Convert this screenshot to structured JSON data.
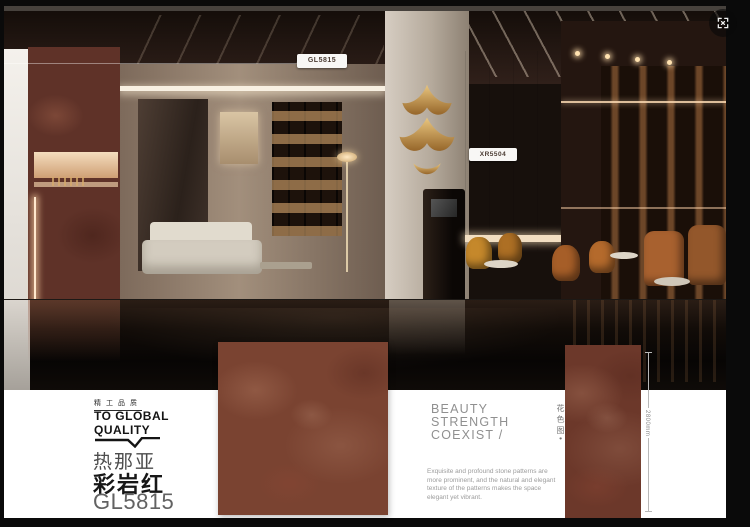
{
  "viewer": {
    "fullscreen_icon": "fullscreen-expand"
  },
  "scene_tags": {
    "left": "GL5815",
    "right": "XR5504"
  },
  "brand": {
    "tagline_cn": "精工品质",
    "line1": "TO GLOBAL",
    "line2": "QUALITY"
  },
  "product": {
    "series": "热那亚",
    "name": "彩岩红",
    "code": "GL5815"
  },
  "slogan": {
    "lines": [
      "BEAUTY",
      "STRENGTH",
      "COEXIST /"
    ]
  },
  "description": {
    "lines": [
      "Exquisite and profound stone patterns are",
      "more prominent, and the natural and elegant",
      "texture of the patterns makes the space",
      "elegant yet vibrant."
    ]
  },
  "swatch": {
    "side_label": "花色图•",
    "dimension": "2800mm"
  },
  "colors": {
    "tile": "#7a4331",
    "tile_dark": "#6c382a",
    "gold": "#c8995c",
    "chair_orange": "#bf7030",
    "panel_white": "#ffffff"
  }
}
